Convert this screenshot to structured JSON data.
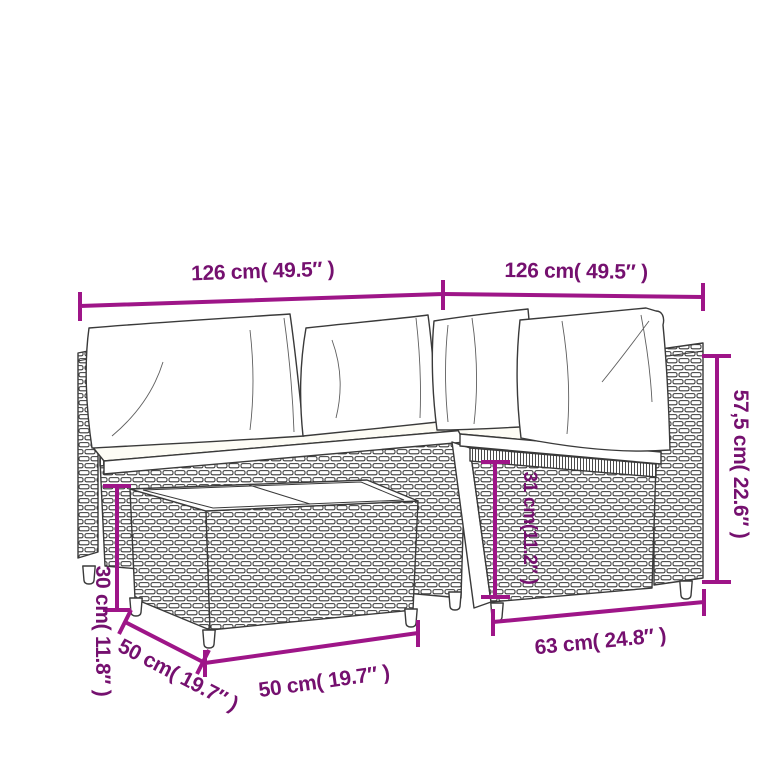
{
  "diagram": {
    "colors": {
      "dimension_line": "#9e1588",
      "dimension_text": "#75106f",
      "line_art": "#3a3a3a",
      "background": "#ffffff"
    },
    "labels": {
      "left_section_width": "126 cm( 49.5″ )",
      "right_section_width": "126 cm( 49.5″ )",
      "total_height": "57,5 cm( 22.6″ )",
      "seat_height": "31 cm(11.2″ )",
      "section_depth": "63 cm( 24.8″ )",
      "table_width": "50 cm( 19.7″ )",
      "table_depth": "50 cm( 19.7″ )",
      "table_height": "30 cm( 11.8″ )"
    }
  }
}
